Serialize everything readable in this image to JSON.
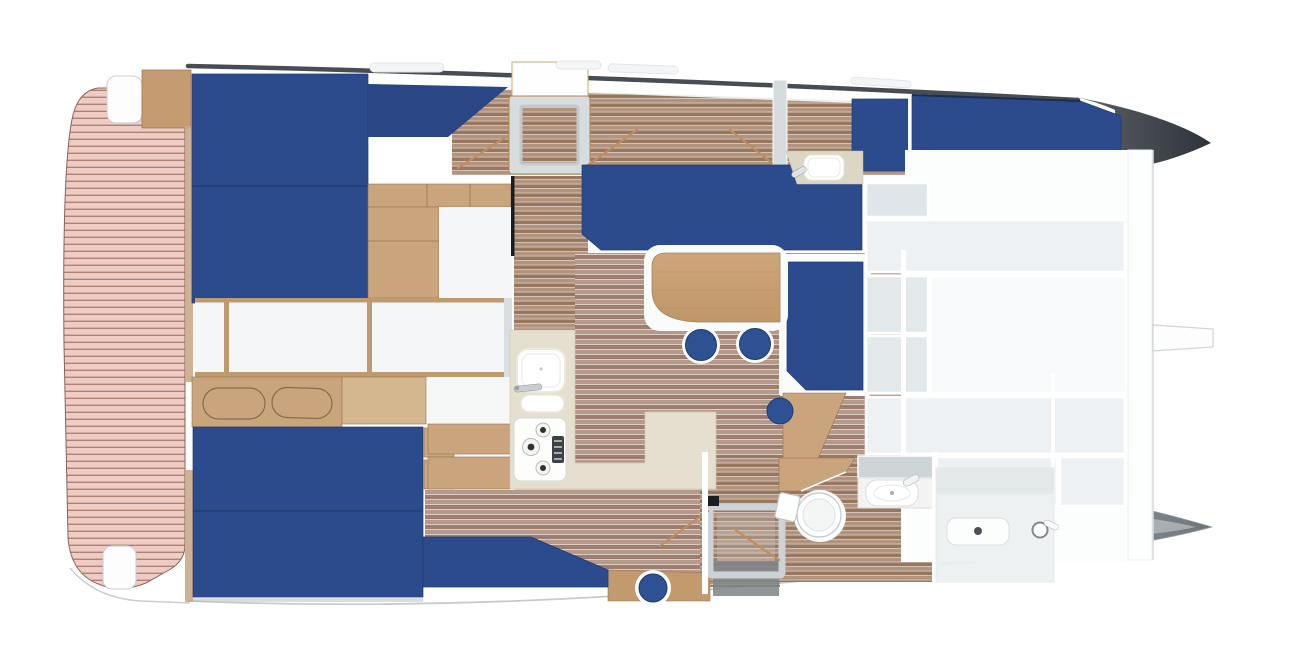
{
  "scene": {
    "title": "Catamaran yacht interior floor plan – overhead 3D render",
    "view": "top-down",
    "orientation": "stern-left, bow-right",
    "background": "#ffffff"
  },
  "palette": {
    "mattress_blue": "#2c4b8d",
    "bolster_blue": "#2a4685",
    "stool_blue": "#2e5193",
    "seam_navy": "#203a70",
    "deck_pink": "#eeccc3",
    "deck_line": "#a3746a",
    "deck_outline": "#8d6157",
    "wood_light": "#c9a47c",
    "wood_mid": "#c29a6e",
    "wood_gangway": "#c59c72",
    "wood_trim": "#c09a6f",
    "wood_dark": "#9a7550",
    "headboard_ext": "#d4b68f",
    "floor_light": "#b59a8c",
    "floor_dark": "#9b7e6f",
    "floor_gap": "#ddcdc1",
    "corridor_light": "#b29380",
    "corridor_dark": "#97785f",
    "corridor_gap": "#d8c8ba",
    "counter_cream": "#e4dfce",
    "bath_counter": "#dcd6c4",
    "roof_edge": "#474d52",
    "hull_tip_light": "#5c6268",
    "hull_tip_dark": "#2f343a",
    "bow_gray_light": "#b4babd",
    "bow_gray_dark": "#6e757a",
    "panel_light": "#eef1f3",
    "panel_mid": "#e3e8eb",
    "panel_dim": "#dfe5e8",
    "panel_bright": "#f7f9fa",
    "wall_gray": "#d6dbde",
    "line_gray": "#d8dcde",
    "rail_tan": "#c08d5f",
    "stairwell_gray": "#7e8487",
    "door_slot_black": "#1b1e21"
  },
  "vessel": {
    "type": "catamaran",
    "hull_count": 2,
    "regions": [
      {
        "id": "aft-deck",
        "label": "Aft deck with planked decking",
        "features": [
          "upper bench seat",
          "lower bench seat",
          "boarding step"
        ]
      },
      {
        "id": "port-aft-cabin",
        "label": "Aft cabin (upper hull)",
        "furniture": [
          "double berth, two cushions",
          "backrest bolster",
          "wardrobe shelves",
          "sliding door"
        ]
      },
      {
        "id": "companionway-hatch",
        "label": "Companionway hatch with skylight"
      },
      {
        "id": "port-corridor",
        "label": "Upper hull corridor with stair rails"
      },
      {
        "id": "salon",
        "label": "Salon",
        "furniture": [
          "long sofa",
          "side sofa",
          "dining table",
          "bar stools"
        ]
      },
      {
        "id": "galley",
        "label": "Galley",
        "furniture": [
          "L-shaped counter",
          "double sink with faucet",
          "three-burner stove",
          "back cabinets"
        ]
      },
      {
        "id": "port-washroom",
        "label": "Washbasin unit (upper hull)",
        "furniture": [
          "cream vanity top",
          "basin",
          "faucet"
        ]
      },
      {
        "id": "port-bow-berth",
        "label": "Bow berth (upper hull)"
      },
      {
        "id": "foredeck-lockers",
        "label": "Foredeck storage locker grid"
      },
      {
        "id": "crossbeam-tab",
        "label": "Forward crossbeam fitting"
      },
      {
        "id": "starboard-aft-cabin",
        "label": "Aft cabin (lower hull)",
        "furniture": [
          "double berth, two cushions",
          "headboard with two oval panels",
          "side shelves"
        ]
      },
      {
        "id": "starboard-settee",
        "label": "Hull settee with angled corner"
      },
      {
        "id": "companionway-stairs",
        "label": "Stairwell to lower hull",
        "features": [
          "wood step block",
          "hand rails",
          "tread shadow"
        ]
      },
      {
        "id": "starboard-bathroom",
        "label": "Bathroom (lower hull)",
        "furniture": [
          "toilet with tank",
          "wood vanity wedge",
          "basin with faucet",
          "shower room",
          "shower drain",
          "shower door handle"
        ]
      },
      {
        "id": "starboard-bow",
        "label": "Lower hull bow (gray molded hull)"
      }
    ],
    "counts": {
      "berths": 4,
      "sofas": 2,
      "bar_stools": 4,
      "sinks": 4,
      "stove_burners": 3,
      "toilets": 1,
      "showers": 1,
      "deck_bench_seats": 2,
      "roof_windows": 4,
      "headboard_oval_panels": 2
    }
  }
}
